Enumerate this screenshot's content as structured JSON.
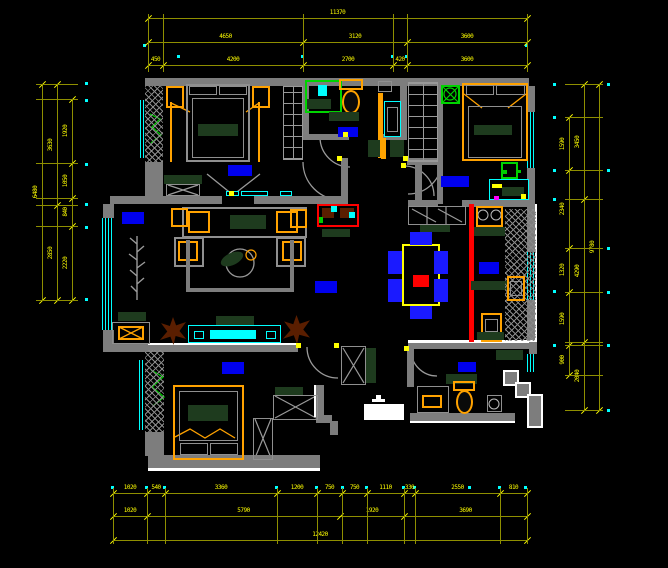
{
  "meta": {
    "drawing_type": "residential-floor-plan",
    "view": "cad-model-space",
    "background": "#000000"
  },
  "palette": {
    "wall": "#7d7d7d",
    "wall_edge": "#ffffff",
    "dimension_line": "#8f8f00",
    "dimension_text": "#ffff00",
    "window": "#00ffff",
    "furniture_accent": "#ffa200",
    "room_label": "#0000ee",
    "chair_blue": "#1a1aff",
    "feature_wall_red": "#ff0000",
    "counter_green": "#1e3b1e",
    "fixture_green": "#00d400",
    "plant_brown": "#5a1e00"
  },
  "dims": {
    "top": {
      "row1": [
        "11370"
      ],
      "row2": [
        "4650",
        "3120",
        "3600"
      ],
      "row3": [
        "450",
        "4200",
        "2700",
        "420",
        "3600"
      ]
    },
    "bottom": {
      "row1": [
        "1020",
        "540",
        "3360",
        "1200",
        "750",
        "750",
        "1110",
        "330",
        "2550",
        "810"
      ],
      "row2": [
        "1020",
        "5790",
        "1920",
        "3690"
      ],
      "row3": [
        "12420"
      ]
    },
    "left": {
      "outer": [
        "6480"
      ],
      "mid": [
        "3630",
        "2850"
      ],
      "inner": [
        "1920",
        "1050",
        "840",
        "2220"
      ]
    },
    "right": {
      "inner": [
        "1590",
        "2340",
        "1320",
        "1590",
        "900"
      ],
      "mid": [
        "3450",
        "4290",
        "2040"
      ],
      "outer": [
        "9780"
      ]
    }
  },
  "symbols": [
    "double-bed",
    "nightstand",
    "canopy-post",
    "wardrobe",
    "dresser",
    "sliding-door",
    "hinged-door-swing",
    "window",
    "bay-window",
    "shower-enclosure",
    "shower-head",
    "toilet",
    "wash-basin",
    "vanity-counter",
    "sofa-set",
    "armchair",
    "coffee-table",
    "tv-cabinet",
    "speaker",
    "potted-plant",
    "decor-console",
    "dining-table",
    "dining-chair",
    "sideboard",
    "gas-stove",
    "kitchen-sink",
    "hatched-counter",
    "washing-machine",
    "entry-threshold",
    "room-label",
    "dimension-chain",
    "reference-point",
    "door-hinge-mark",
    "feature-wall"
  ]
}
